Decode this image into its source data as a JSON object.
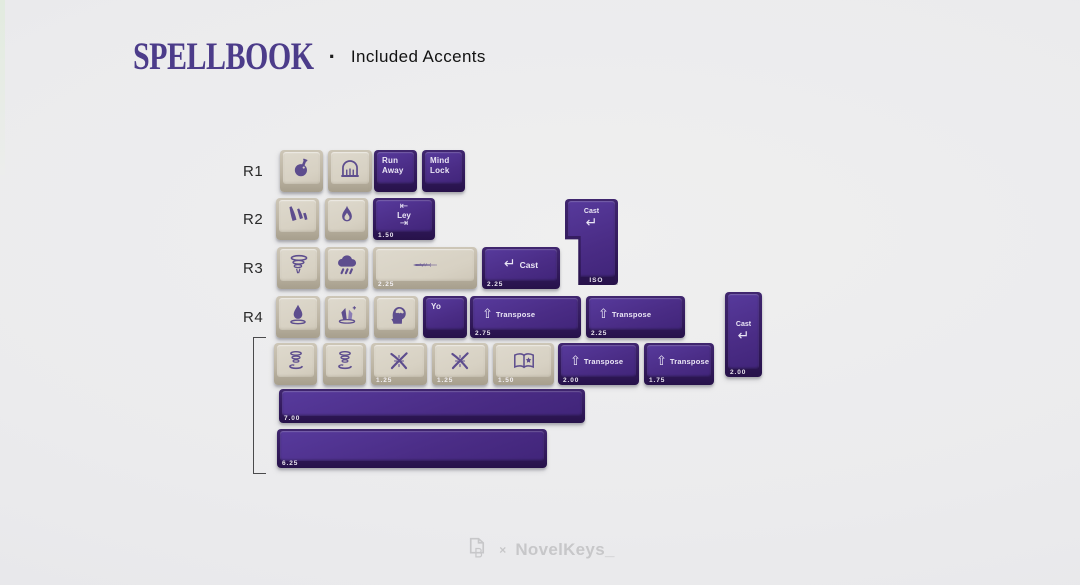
{
  "header": {
    "brand": "SPELLBOOK",
    "separator": "·",
    "subtitle": "Included Accents"
  },
  "row_labels": [
    "R1",
    "R2",
    "R3",
    "R4"
  ],
  "colors": {
    "title_purple": "#4c3c8a",
    "keycap_purple": "#4a2c85",
    "keycap_beige": "#d7d1c3",
    "legend_light": "#eae6f5",
    "icon_purple": "#5d4d8e",
    "background": "#ebebed",
    "footer_gray": "#c7c7c9"
  },
  "keyboard": {
    "keys": [
      {
        "name": "keycap-potion",
        "color": "beige",
        "type": "icon",
        "icon": "potion-icon",
        "x": 280,
        "y": 150,
        "w": 43,
        "h": 42
      },
      {
        "name": "keycap-gate",
        "color": "beige",
        "type": "icon",
        "icon": "gate-icon",
        "x": 328,
        "y": 150,
        "w": 44,
        "h": 42
      },
      {
        "name": "keycap-run-away",
        "color": "purple",
        "type": "lines",
        "lines": [
          "Run",
          "Away"
        ],
        "x": 374,
        "y": 150,
        "w": 43,
        "h": 42
      },
      {
        "name": "keycap-mind-lock",
        "color": "purple",
        "type": "lines",
        "lines": [
          "Mind",
          "Lock"
        ],
        "x": 422,
        "y": 150,
        "w": 43,
        "h": 42
      },
      {
        "name": "keycap-meteor",
        "color": "beige",
        "type": "icon",
        "icon": "meteor-icon",
        "x": 276,
        "y": 198,
        "w": 43,
        "h": 42
      },
      {
        "name": "keycap-flame",
        "color": "beige",
        "type": "icon",
        "icon": "flame-icon",
        "x": 325,
        "y": 198,
        "w": 43,
        "h": 42
      },
      {
        "name": "keycap-ley",
        "color": "purple",
        "type": "tab",
        "tab_top": "⇤",
        "label": "Ley",
        "tab_bottom": "⇥",
        "front": "1.50",
        "x": 373,
        "y": 198,
        "w": 62,
        "h": 42
      },
      {
        "name": "keycap-cast-iso-enter",
        "color": "purple",
        "type": "enter_v",
        "label": "Cast",
        "arrow": "↵",
        "front": "ISO",
        "shape": "iso",
        "x": 565,
        "y": 199,
        "w": 53,
        "h": 86
      },
      {
        "name": "keycap-tornado",
        "color": "beige",
        "type": "icon",
        "icon": "tornado-icon",
        "x": 277,
        "y": 247,
        "w": 43,
        "h": 42
      },
      {
        "name": "keycap-storm",
        "color": "beige",
        "type": "icon",
        "icon": "storm-icon",
        "x": 325,
        "y": 247,
        "w": 43,
        "h": 42
      },
      {
        "name": "keycap-sword",
        "color": "beige",
        "type": "icon",
        "icon": "sword-icon",
        "front": "2.25",
        "x": 373,
        "y": 247,
        "w": 104,
        "h": 42
      },
      {
        "name": "keycap-cast",
        "color": "purple",
        "type": "enter_h",
        "arrow": "↵",
        "label": "Cast",
        "front": "2.25",
        "x": 482,
        "y": 247,
        "w": 78,
        "h": 42
      },
      {
        "name": "keycap-droplet",
        "color": "beige",
        "type": "icon",
        "icon": "droplet-icon",
        "x": 276,
        "y": 296,
        "w": 44,
        "h": 42
      },
      {
        "name": "keycap-crystal",
        "color": "beige",
        "type": "icon",
        "icon": "crystal-icon",
        "x": 325,
        "y": 296,
        "w": 44,
        "h": 42
      },
      {
        "name": "keycap-head",
        "color": "beige",
        "type": "icon",
        "icon": "head-icon",
        "x": 374,
        "y": 296,
        "w": 44,
        "h": 42
      },
      {
        "name": "keycap-yo",
        "color": "purple",
        "type": "lines",
        "lines": [
          "Yo"
        ],
        "x": 423,
        "y": 296,
        "w": 44,
        "h": 42
      },
      {
        "name": "keycap-transpose-275",
        "color": "purple",
        "type": "shift",
        "arrow": "⇧",
        "label": "Transpose",
        "front": "2.75",
        "x": 470,
        "y": 296,
        "w": 111,
        "h": 42
      },
      {
        "name": "keycap-transpose-225",
        "color": "purple",
        "type": "shift",
        "arrow": "⇧",
        "label": "Transpose",
        "front": "2.25",
        "x": 586,
        "y": 296,
        "w": 99,
        "h": 42
      },
      {
        "name": "keycap-cast-vertical",
        "color": "purple",
        "type": "enter_v",
        "label": "Cast",
        "arrow": "↵",
        "front": "2.00",
        "x": 725,
        "y": 292,
        "w": 37,
        "h": 85
      },
      {
        "name": "keycap-levitate-1",
        "color": "beige",
        "type": "icon",
        "icon": "levitate-icon",
        "x": 274,
        "y": 343,
        "w": 43,
        "h": 42
      },
      {
        "name": "keycap-levitate-2",
        "color": "beige",
        "type": "icon",
        "icon": "levitate-icon",
        "x": 323,
        "y": 343,
        "w": 43,
        "h": 42
      },
      {
        "name": "keycap-wands-1",
        "color": "beige",
        "type": "icon",
        "icon": "wands-icon",
        "front": "1.25",
        "x": 371,
        "y": 343,
        "w": 56,
        "h": 42
      },
      {
        "name": "keycap-wands-2",
        "color": "beige",
        "type": "icon",
        "icon": "wands-icon",
        "front": "1.25",
        "x": 432,
        "y": 343,
        "w": 56,
        "h": 42
      },
      {
        "name": "keycap-book",
        "color": "beige",
        "type": "icon",
        "icon": "book-icon",
        "front": "1.50",
        "x": 493,
        "y": 343,
        "w": 61,
        "h": 42
      },
      {
        "name": "keycap-transpose-200",
        "color": "purple",
        "type": "shift",
        "arrow": "⇧",
        "label": "Transpose",
        "front": "2.00",
        "x": 558,
        "y": 343,
        "w": 81,
        "h": 42
      },
      {
        "name": "keycap-transpose-175",
        "color": "purple",
        "type": "shift",
        "arrow": "⇧",
        "label": "Transpose",
        "front": "1.75",
        "x": 644,
        "y": 343,
        "w": 70,
        "h": 42
      },
      {
        "name": "keycap-spacebar-7u",
        "color": "purple",
        "type": "space",
        "front": "7.00",
        "x": 279,
        "y": 389,
        "w": 306,
        "h": 34
      },
      {
        "name": "keycap-spacebar-625u",
        "color": "purple",
        "type": "space",
        "front": "6.25",
        "x": 277,
        "y": 429,
        "w": 270,
        "h": 39
      }
    ]
  },
  "footer": {
    "collab_separator": "×",
    "brand": "NovelKeys_"
  }
}
